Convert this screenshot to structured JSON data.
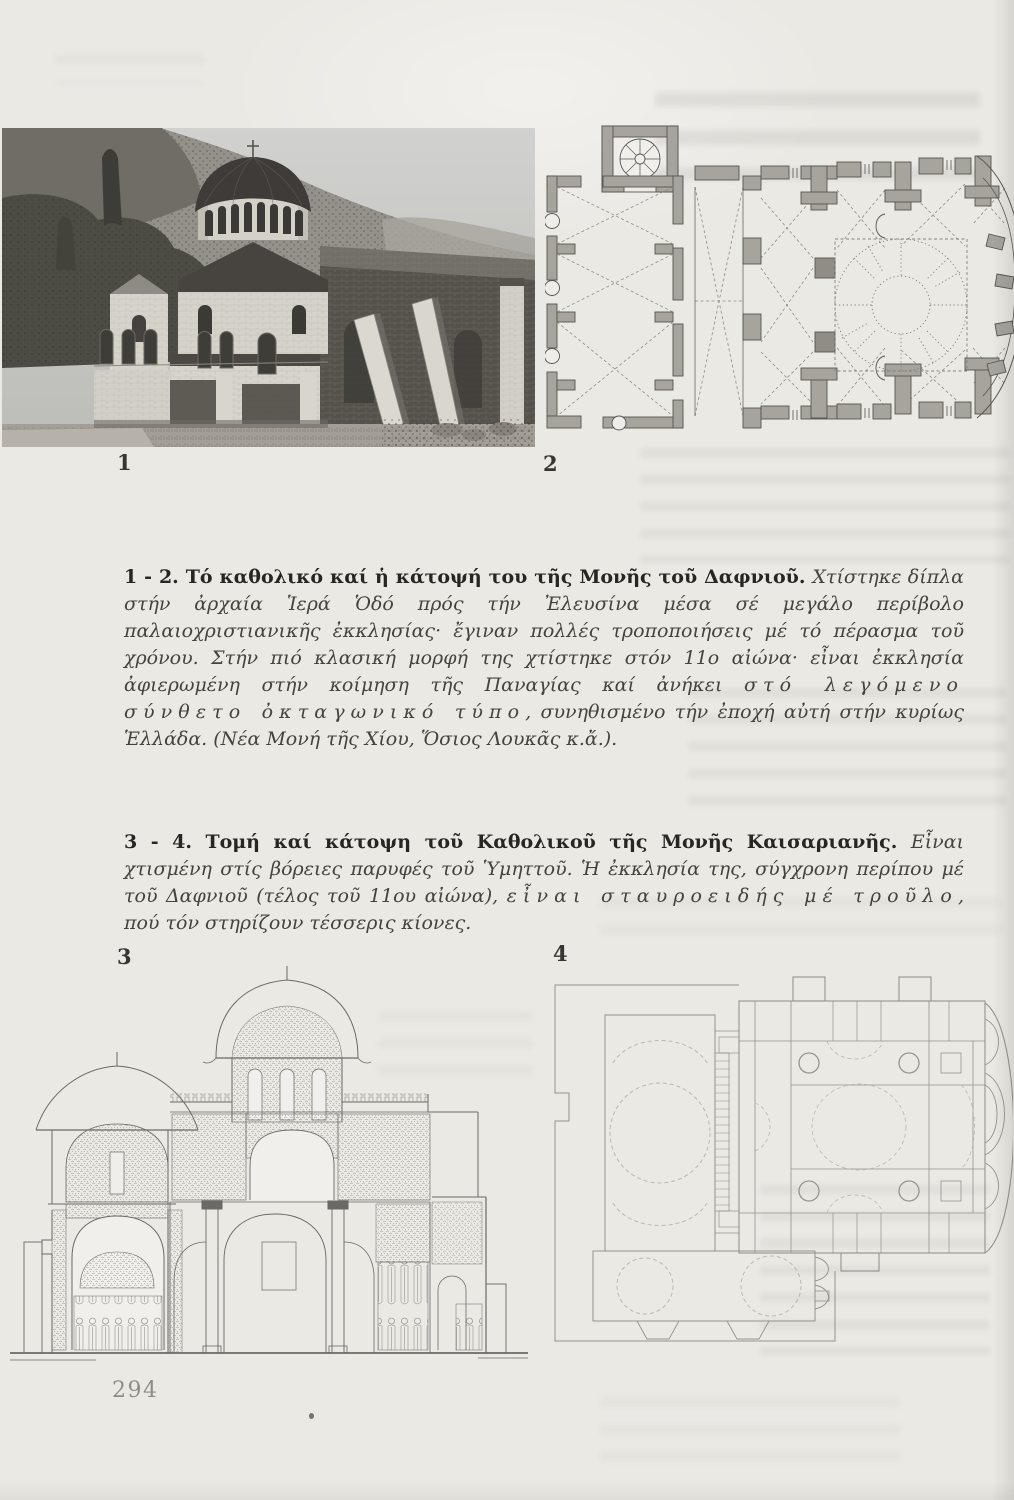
{
  "page": {
    "number": "294",
    "bg_color": "#ebe9e4"
  },
  "figures": [
    {
      "label": "1",
      "kind": "photograph",
      "name": "daphni-katholikon-photo"
    },
    {
      "label": "2",
      "kind": "floor-plan",
      "name": "daphni-monastery-plan"
    },
    {
      "label": "3",
      "kind": "section-drawing",
      "name": "kaisariani-katholikon-section"
    },
    {
      "label": "4",
      "kind": "floor-plan",
      "name": "kaisariani-monastery-plan"
    }
  ],
  "captions": [
    {
      "segments": [
        {
          "style": "bold",
          "text": "1 - 2. Τό καθολικό καί ἡ κάτοψή του τῆς Μονῆς τοῦ Δαφνιοῦ. "
        },
        {
          "style": "italic",
          "text": "Χτίστηκε δίπλα στήν ἀρχαία Ἱερά Ὁδό πρός τήν Ἐλευσίνα μέσα σέ μεγάλο περίβολο παλαιοχριστιανικῆς ἐκκλησίας· ἔγιναν πολλές τροποποιήσεις μέ τό πέρασμα τοῦ χρόνου. Στήν πιό κλασική μορφή της χτίστηκε στόν 11ο αἰώνα· εἶναι ἐκκλησία ἀφιερωμένη στήν κοίμηση τῆς Παναγίας καί ἀνήκει "
        },
        {
          "style": "italic-spaced",
          "text": "στό λεγόμενο σύνθετο ὀκταγωνικό τύπο"
        },
        {
          "style": "italic",
          "text": ", συνηθισμένο τήν ἐποχή αὐτή στήν κυρίως Ἑλλάδα. (Νέα Μονή τῆς Χίου, Ὅσιος Λουκᾶς κ.ἄ.)."
        }
      ]
    },
    {
      "segments": [
        {
          "style": "bold",
          "text": "3 - 4. Τομή καί κάτοψη τοῦ Καθολικοῦ τῆς Μονῆς Καισαριανῆς. "
        },
        {
          "style": "italic",
          "text": "Εἶναι χτισμένη στίς βόρειες παρυφές τοῦ Ὑμηττοῦ. Ἡ ἐκκλησία της, σύγχρονη περίπου μέ τοῦ Δαφνιοῦ (τέλος τοῦ 11ου αἰώνα), "
        },
        {
          "style": "italic-spaced",
          "text": "εἶναι σταυροειδής μέ τροῦλο"
        },
        {
          "style": "italic",
          "text": ", πού τόν στηρίζουν τέσσερις κίονες."
        }
      ]
    }
  ]
}
